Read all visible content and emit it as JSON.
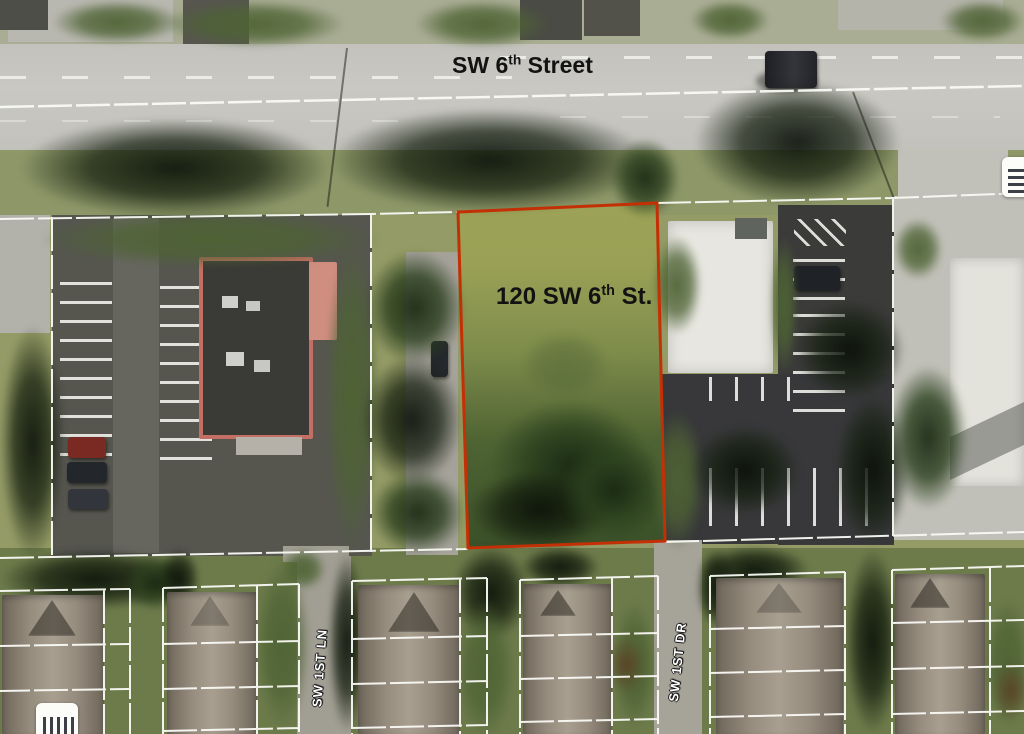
{
  "map": {
    "type_note": "aerial parcel map",
    "road": {
      "label_prefix": "SW 6",
      "label_sup": "th",
      "label_suffix": " Street"
    },
    "parcel": {
      "label_prefix": "120 SW 6",
      "label_sup": "th",
      "label_suffix": " St.",
      "outline_color": "#c33005"
    },
    "streets": {
      "lane": "SW 1ST LN",
      "drive": "SW 1ST DR"
    },
    "boundary_line_color": "#ffffff",
    "icons": {
      "right_edge": "list-icon",
      "bottom_left": "stripes-icon"
    }
  }
}
